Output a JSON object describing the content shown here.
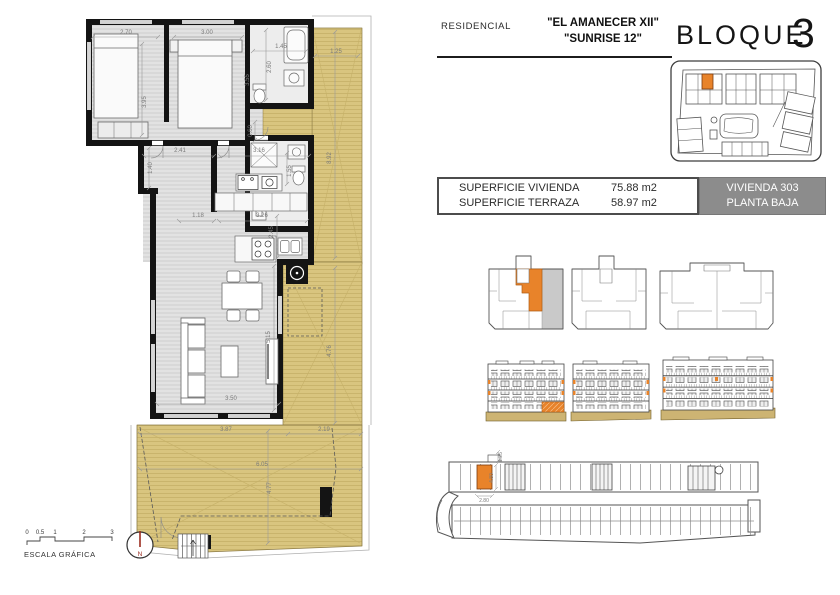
{
  "header": {
    "residencial_label": "RESIDENCIAL",
    "name_line1": "\"EL AMANECER XII\"",
    "name_line2": "\"SUNRISE 12\"",
    "bloque_label": "BLOQUE",
    "bloque_number": "3"
  },
  "info_box": {
    "row1_label": "SUPERFICIE VIVIENDA",
    "row1_value": "75.88 m2",
    "row2_label": "SUPERFICIE TERRAZA",
    "row2_value": "58.97 m2",
    "unit_line1": "VIVIENDA 303",
    "unit_line2": "PLANTA BAJA"
  },
  "plan": {
    "dims": {
      "bed1_w": "2.70",
      "bed2_w": "3.00",
      "bath1_w": "1.45",
      "terr_top_w": "1.25",
      "bed1_h": "3.95",
      "bed2_h": "3.55",
      "bath1_h": "2.60",
      "hall_h": "1.40",
      "hall_w1": "2.41",
      "hall_w2": "3.16",
      "bath2_h": "1.55",
      "pass_h": "0.60",
      "terr_right_h": "8.92",
      "kit_w1": "1.18",
      "kit_w2": "3.26",
      "kit_h": "2.45",
      "living_h": "5.15",
      "terr_mid_h": "4.76",
      "living_w": "3.50",
      "terr_bot_w1": "3.87",
      "terr_bot_w2": "2.19",
      "terr_bot_w": "6.05",
      "terr_bot_h": "4.77"
    },
    "scale": {
      "t0": "0",
      "t1": "0.5",
      "t2": "1",
      "t3": "2",
      "t4": "3",
      "caption": "ESCALA GRÁFICA"
    },
    "north": "N"
  },
  "garage": {
    "dims": {
      "top": "1.25",
      "side": "4.80",
      "width": "2.80"
    }
  },
  "colors": {
    "terrace_tan": "#d9c57f",
    "highlight_orange": "#e8832a",
    "unit_panel_gray": "#8c8c8c",
    "wall_black": "#141414",
    "drawing_gray": "#666666",
    "north_red": "#9b2c20"
  }
}
